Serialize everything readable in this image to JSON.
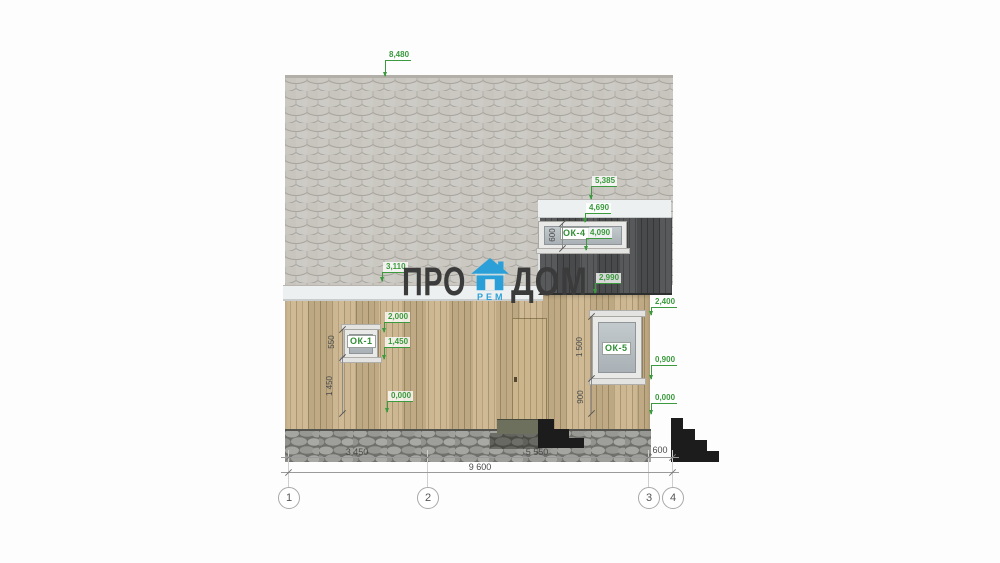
{
  "watermark": {
    "word_left": "ПРО",
    "word_right": "ДОМ",
    "word_sub": "РЕМ"
  },
  "window_labels": {
    "w1": "ОК-1",
    "w4": "ОК-4",
    "w5": "ОК-5"
  },
  "elevation_marks": {
    "ridge": "8,480",
    "upper_eave": "5,385",
    "ok4_top": "4,690",
    "ok4_bottom": "4,090",
    "left_eave": "3,110",
    "gable_bottom": "2,990",
    "ok5_top": "2,400",
    "ok1_top": "2,000",
    "ok1_sill": "1,450",
    "ground_left": "0,000",
    "ok5_sill": "0,900",
    "ground_right": "0,000"
  },
  "vertical_dimensions": {
    "ok1_height": "550",
    "ok1_sill_height": "1 450",
    "ok4_height": "600",
    "ok5_height": "1 500",
    "ok5_sill_height": "900"
  },
  "horizontal_dimensions": {
    "span_1_2": "3 450",
    "span_2_3": "5 550",
    "span_3_4": "600",
    "overall": "9 600"
  },
  "axes": {
    "a1": "1",
    "a2": "2",
    "a3": "3",
    "a4": "4"
  },
  "colors": {
    "accent_green": "#3a9a3d",
    "brand_blue": "#2ba0d8",
    "watermark_gray": "#3b3b3c",
    "shingle_gray": "#cbc8c2",
    "siding_tan": "#c8b28a",
    "gable_dark": "#4e5051"
  }
}
